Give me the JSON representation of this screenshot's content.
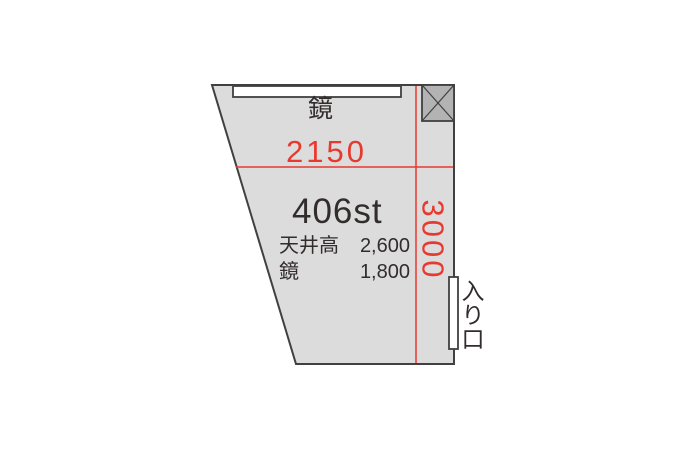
{
  "floorplan": {
    "room_label": "406st",
    "top_mirror_label": "鏡",
    "width_dimension": "2150",
    "height_dimension": "3000",
    "entrance_label": "入り口",
    "specs": [
      {
        "label": "天井高",
        "value": "2,600"
      },
      {
        "label": "鏡",
        "value": "1,800"
      }
    ],
    "colors": {
      "dimension_red": "#e8392f",
      "room_fill": "#dcdcdd",
      "hatch_fill": "#b3b3b4",
      "wall_stroke": "#404040",
      "text_dark": "#322c2c",
      "background": "#ffffff"
    }
  }
}
